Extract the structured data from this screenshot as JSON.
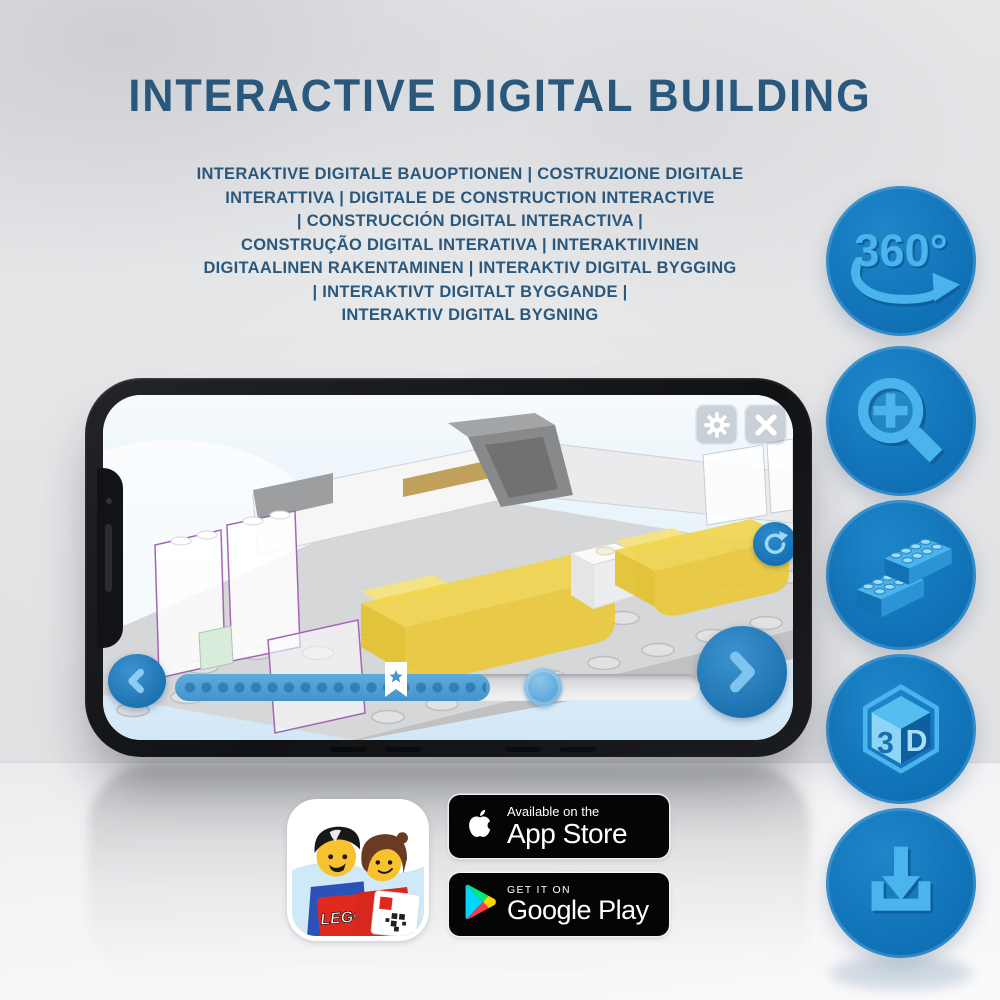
{
  "page": {
    "title": "INTERACTIVE DIGITAL BUILDING",
    "subtitle_lines": [
      "INTERAKTIVE DIGITALE BAUOPTIONEN | COSTRUZIONE DIGITALE",
      "INTERATTIVA | DIGITALE DE CONSTRUCTION INTERACTIVE",
      "| CONSTRUCCIÓN DIGITAL INTERACTIVA |",
      "CONSTRUÇÃO DIGITAL INTERATIVA | INTERAKTIIVINEN",
      "DIGITAALINEN RAKENTAMINEN | INTERAKTIV DIGITAL BYGGING",
      "| INTERAKTIVT DIGITALT BYGGANDE |",
      "INTERAKTIV DIGITAL BYGNING"
    ]
  },
  "features": {
    "rotation_label": "360°",
    "cube_left_label": "3",
    "cube_right_label": "D",
    "icon_names": [
      "360-rotation-icon",
      "zoom-in-icon",
      "brick-stack-icon",
      "3d-cube-icon",
      "download-icon"
    ]
  },
  "phone_app": {
    "progress_percent_complete": 60,
    "bookmark_percent": 42
  },
  "badges": {
    "lego_app_label": "LEGO",
    "app_store": {
      "tagline": "Available on the",
      "store_name": "App Store"
    },
    "google_play": {
      "tagline": "GET IT ON",
      "store_name": "Google Play"
    }
  },
  "colors": {
    "title_blue": "#2a587c",
    "feature_circle_blue": "#1176bc",
    "icon_light_blue": "#4cb4ec",
    "bed_yellow": "#f1d54a",
    "badge_black": "#050506"
  }
}
